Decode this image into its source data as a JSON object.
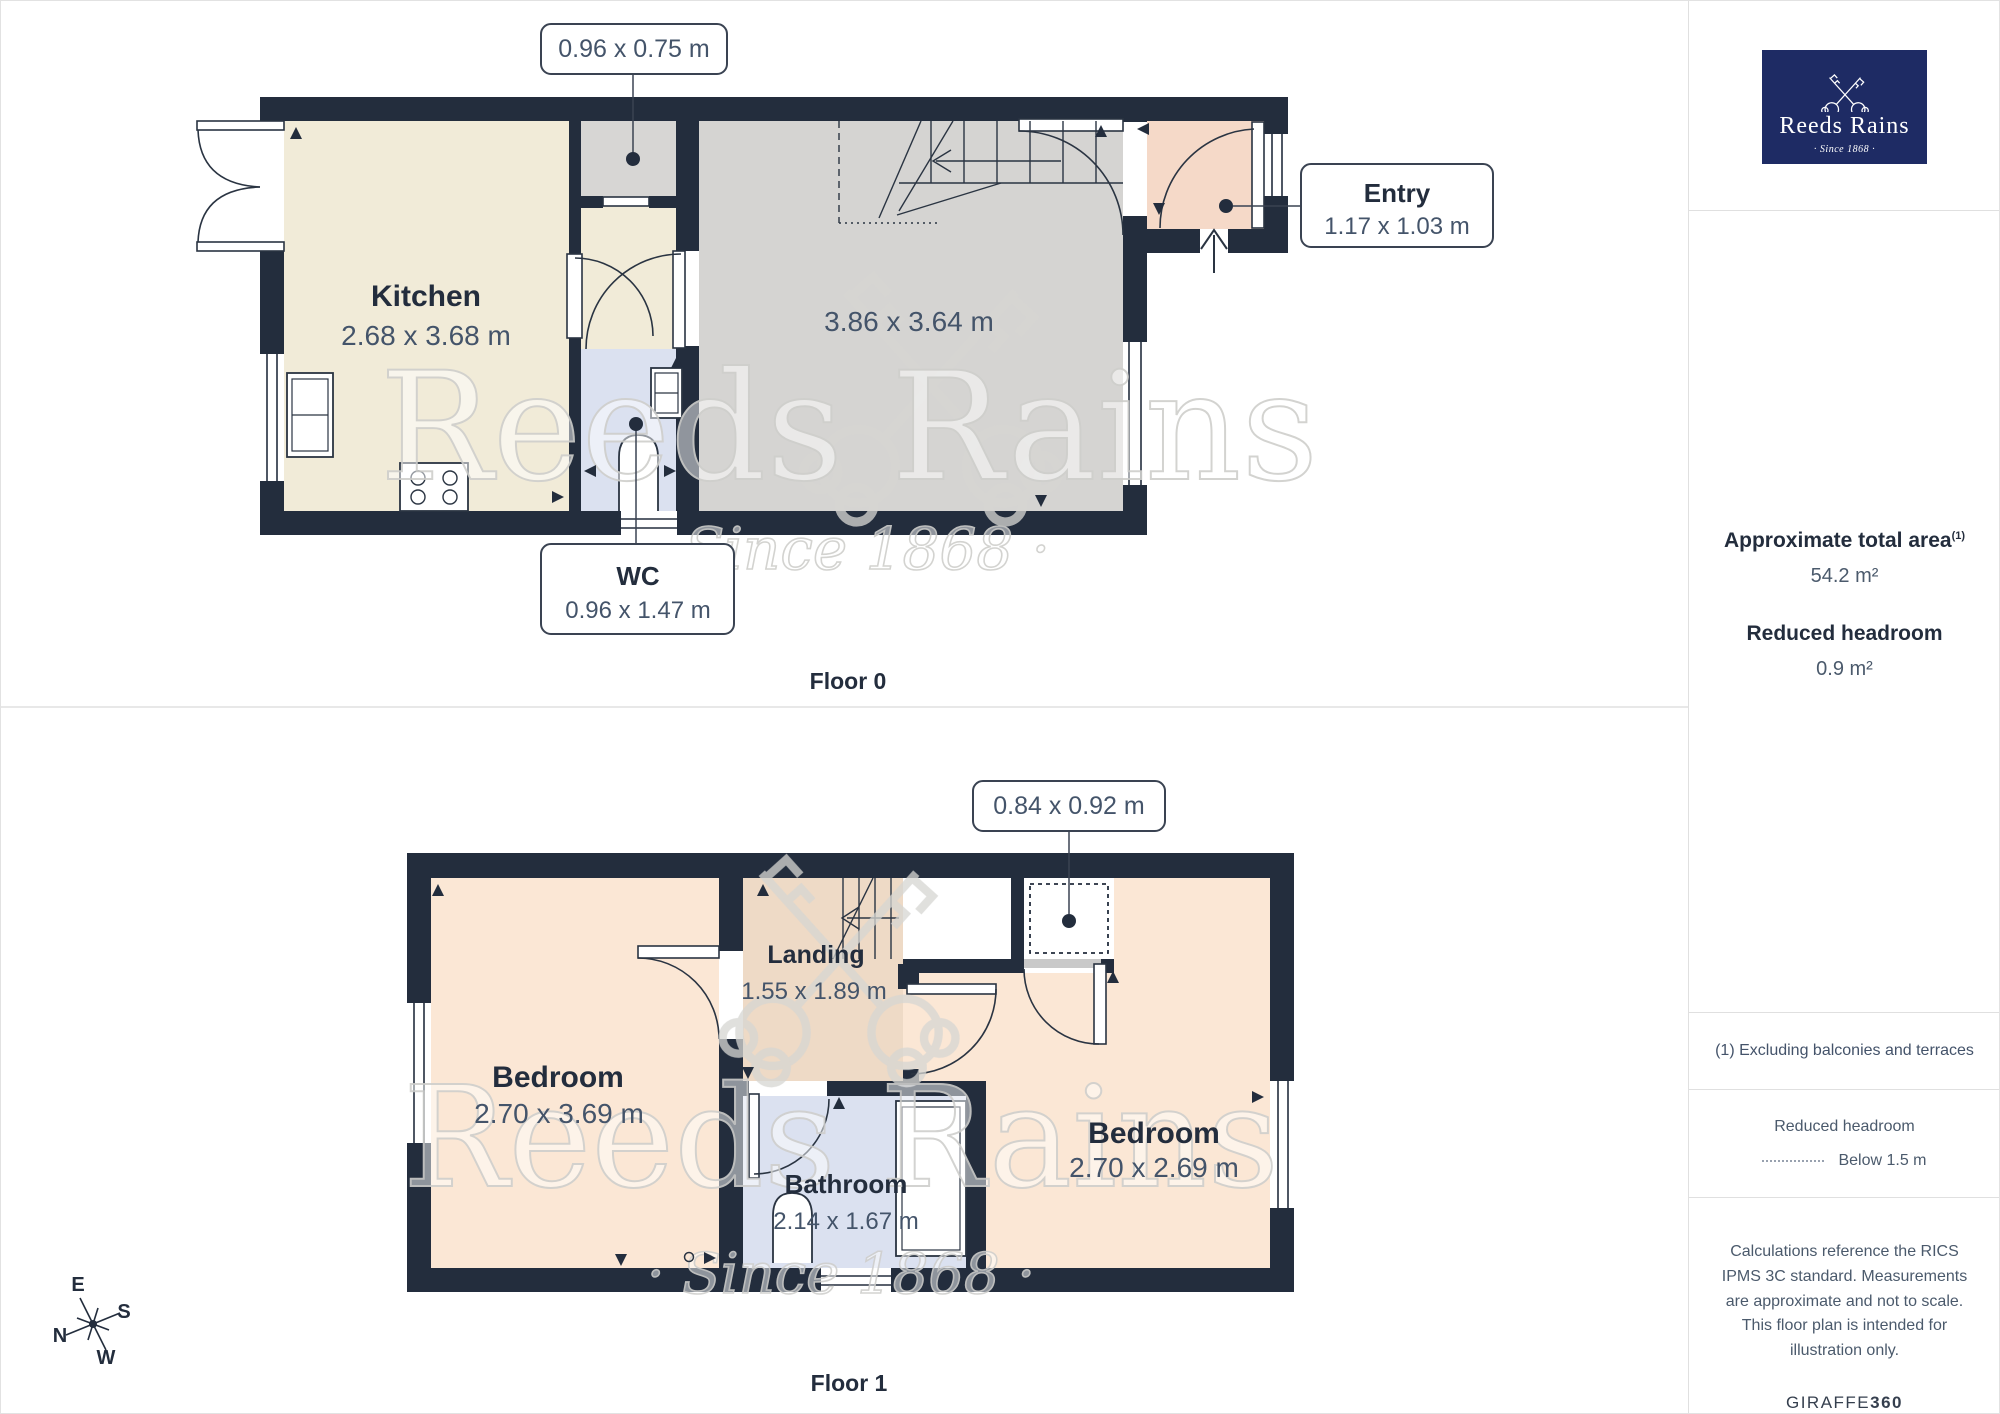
{
  "brand": {
    "name": "Reeds Rains",
    "tagline": "· Since 1868 ·"
  },
  "watermark": {
    "line1": "Reeds Rains",
    "line2": "· Since 1868 ·"
  },
  "floor0": {
    "title": "Floor 0",
    "rooms": {
      "kitchen": {
        "name": "Kitchen",
        "dims": "2.68 x 3.68 m"
      },
      "living": {
        "dims": "3.86 x 3.64 m"
      },
      "wc": {
        "name": "WC",
        "dims": "0.96 x 1.47 m"
      },
      "entry": {
        "name": "Entry",
        "dims": "1.17 x 1.03 m"
      },
      "closet": {
        "dims": "0.96 x 0.75 m"
      }
    }
  },
  "floor1": {
    "title": "Floor 1",
    "rooms": {
      "bedroom_left": {
        "name": "Bedroom",
        "dims": "2.70 x 3.69 m"
      },
      "bedroom_right": {
        "name": "Bedroom",
        "dims": "2.70 x 2.69 m"
      },
      "landing": {
        "name": "Landing",
        "dims": "1.55 x 1.89 m"
      },
      "bathroom": {
        "name": "Bathroom",
        "dims": "2.14 x 1.67 m"
      },
      "closet": {
        "dims": "0.84 x 0.92 m"
      }
    }
  },
  "compass": {
    "n": "N",
    "e": "E",
    "s": "S",
    "w": "W"
  },
  "sidebar": {
    "area_heading": "Approximate total area",
    "area_superscript": "(1)",
    "area_value": "54.2 m²",
    "headroom_heading": "Reduced headroom",
    "headroom_value": "0.9 m²",
    "footnote": "(1) Excluding balconies and terraces",
    "legend_title": "Reduced headroom",
    "legend_item": "Below 1.5 m",
    "disclaimer": "Calculations reference the RICS IPMS 3C standard. Measurements are approximate and not to scale. This floor plan is intended for illustration only.",
    "brand_footer_normal": "GIRAFFE",
    "brand_footer_bold": "360"
  },
  "colors": {
    "wall": "#232d3d",
    "kitchen": "#f1ebd8",
    "living_room": "#d5d4d2",
    "entry": "#f5d9c8",
    "wc_bathroom": "#dbe1f0",
    "bedroom": "#fbe7d5",
    "landing": "#eedac6",
    "closet": "#d7d6d4",
    "logo_background": "#1e2b64",
    "divider": "#e0e0e0",
    "watermark": "#d6d6d3"
  }
}
